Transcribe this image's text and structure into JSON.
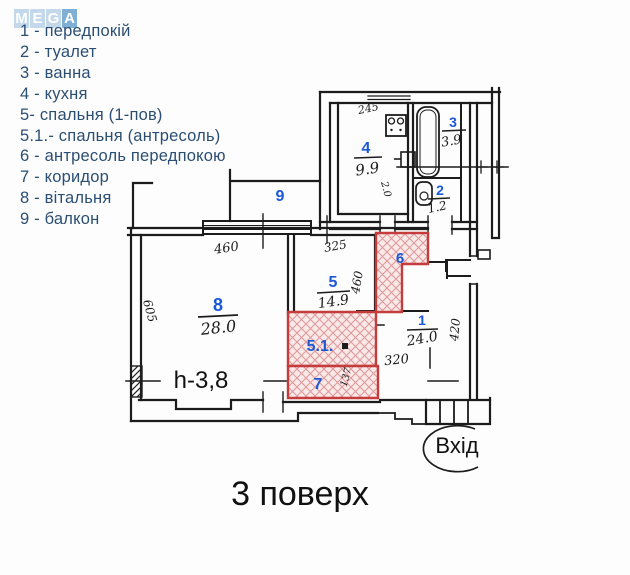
{
  "logo": {
    "letters": [
      "M",
      "E",
      "G",
      "A"
    ]
  },
  "legend": {
    "items": [
      "1 - передпокій",
      "2 - туалет",
      "3 - ванна",
      "4 - кухня",
      "5- спальня (1-пов)",
      "5.1.- спальня (антресоль)",
      "6 - антресоль передпокою",
      "7 - коридор",
      "8 - вітальня",
      "9 - балкон"
    ]
  },
  "plan": {
    "floor_label": "3 поверх",
    "entrance_label": "Вхід",
    "ceiling_height_label": "h-3,8",
    "rooms": {
      "r1": {
        "number": "1",
        "area": "24.0"
      },
      "r2": {
        "number": "2",
        "area": "1.2"
      },
      "r3": {
        "number": "3",
        "area": "3.9"
      },
      "r4": {
        "number": "4",
        "area": "9.9"
      },
      "r5": {
        "number": "5",
        "area": "14.9"
      },
      "r51": {
        "number": "5.1."
      },
      "r6": {
        "number": "6"
      },
      "r7": {
        "number": "7"
      },
      "r8": {
        "number": "8",
        "area": "28.0"
      },
      "r9": {
        "number": "9"
      }
    },
    "dimensions": {
      "kitchen_width": "245",
      "kitchen_side": "2.0",
      "room8_width": "460",
      "room8_depth": "605",
      "room5_width": "325",
      "room5_depth": "460",
      "room1_width": "320",
      "room1_depth": "420",
      "corridor": "137"
    },
    "colors": {
      "room_number_blue": "#1b58d8",
      "legend_text": "#2b4e73",
      "hatch_border_red": "#c43c3c",
      "hatch_fill": "#f9e9e9",
      "wall_black": "#1c1c1c",
      "logo_tile_light": "#c3d8ea",
      "logo_tile_dark": "#7fafd4"
    }
  }
}
